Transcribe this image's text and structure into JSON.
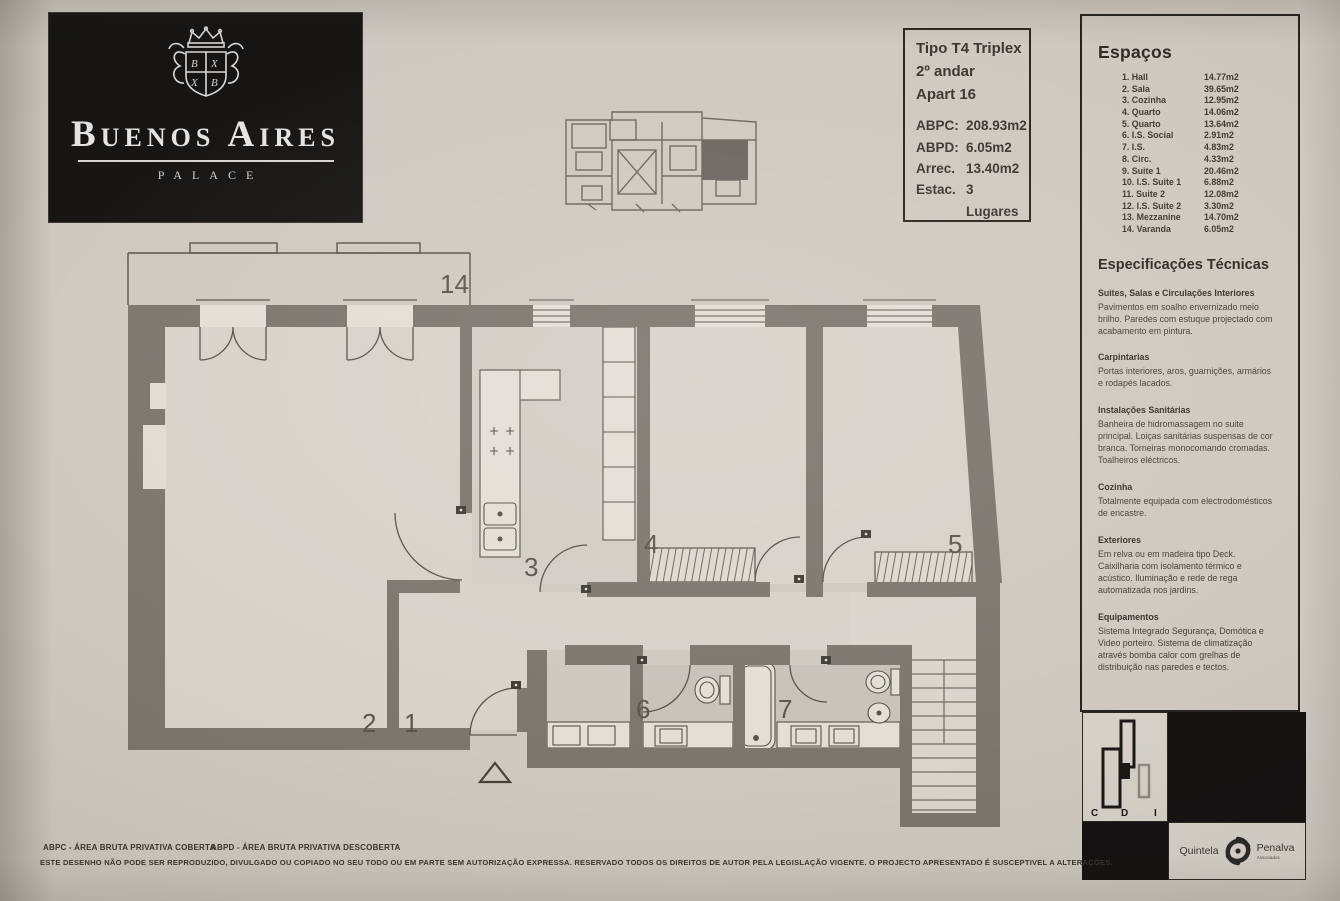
{
  "colors": {
    "paper": "#cfc9c1",
    "wall": "#7b766e",
    "floor": "#d7d2ca",
    "bath_floor": "#c7c2ba",
    "panel_black": "#151312",
    "ink": "#39352f"
  },
  "logo": {
    "name": "Buenos Aires",
    "subtitle": "PALACE"
  },
  "info_box": {
    "type": "Tipo T4 Triplex",
    "floor": "2º andar",
    "apartment": "Apart 16",
    "metrics": [
      {
        "label": "ABPC:",
        "value": "208.93m2"
      },
      {
        "label": "ABPD:",
        "value": "6.05m2"
      },
      {
        "label": "Arrec.",
        "value": "13.40m2"
      },
      {
        "label": "Estac.",
        "value": "3 Lugares"
      }
    ]
  },
  "spaces": {
    "title": "Espaços",
    "items": [
      {
        "label": "1. Hall",
        "area": "14.77m2"
      },
      {
        "label": "2. Sala",
        "area": "39.65m2"
      },
      {
        "label": "3. Cozinha",
        "area": "12.95m2"
      },
      {
        "label": "4. Quarto",
        "area": "14.06m2"
      },
      {
        "label": "5. Quarto",
        "area": "13.64m2"
      },
      {
        "label": "6. I.S. Social",
        "area": "2.91m2"
      },
      {
        "label": "7. I.S.",
        "area": "4.83m2"
      },
      {
        "label": "8. Circ.",
        "area": "4.33m2"
      },
      {
        "label": "9. Suite 1",
        "area": "20.46m2"
      },
      {
        "label": "10. I.S. Suite 1",
        "area": "6.88m2"
      },
      {
        "label": "11. Suite 2",
        "area": "12.08m2"
      },
      {
        "label": "12. I.S. Suite 2",
        "area": "3.30m2"
      },
      {
        "label": "13. Mezzanine",
        "area": "14.70m2"
      },
      {
        "label": "14. Varanda",
        "area": "6.05m2"
      }
    ]
  },
  "specs": {
    "title": "Especificações Técnicas",
    "sections": [
      {
        "heading": "Suites, Salas e Circulações Interiores",
        "body": "Pavimentos em soalho envernizado meio brilho. Paredes com estuque projectado com acabamento em pintura."
      },
      {
        "heading": "Carpintarias",
        "body": "Portas interiores, aros, guarnições, armários e rodapés lacados."
      },
      {
        "heading": "Instalações Sanitárias",
        "body": "Banheira de hidromassagem no suite principal. Loiças sanitárias suspensas de cor branca. Torneiras monocomando cromadas. Toalheiros eléctricos."
      },
      {
        "heading": "Cozinha",
        "body": "Totalmente equipada com electrodomésticos de encastre."
      },
      {
        "heading": "Exteriores",
        "body": "Em relva ou em madeira tipo Deck. Caixilharia com isolamento térmico e acústico. Iluminação e rede de rega automatizada nos jardins."
      },
      {
        "heading": "Equipamentos",
        "body": "Sistema Integrado Segurança, Domótica e Video porteiro. Sistema de climatização através bomba calor com grelhas de distribuição nas paredes e tectos."
      }
    ]
  },
  "plan": {
    "labels": {
      "varanda": "14",
      "sala": "2",
      "hall": "1",
      "cozinha": "3",
      "quarto_4": "4",
      "quarto_5": "5",
      "is_social": "6",
      "is": "7"
    }
  },
  "footer": {
    "abpc": "ABPC - ÁREA BRUTA PRIVATIVA COBERTA",
    "abpd": "ABPD - ÁREA BRUTA PRIVATIVA DESCOBERTA",
    "disclaimer": "ESTE DESENHO NÃO PODE SER REPRODUZIDO, DIVULGADO OU COPIADO NO SEU TODO OU EM PARTE SEM AUTORIZAÇÃO EXPRESSA. RESERVADO TODOS OS DIREITOS DE AUTOR PELA LEGISLAÇÃO VIGENTE. O PROJECTO APRESENTADO É SUSCEPTIVEL A ALTERAÇÕES."
  },
  "brands": {
    "cdi": {
      "c": "C",
      "d": "D",
      "i": "I"
    },
    "quintela": "Quintela",
    "penalva": "Penalva",
    "penalva_sub": "Associados"
  }
}
